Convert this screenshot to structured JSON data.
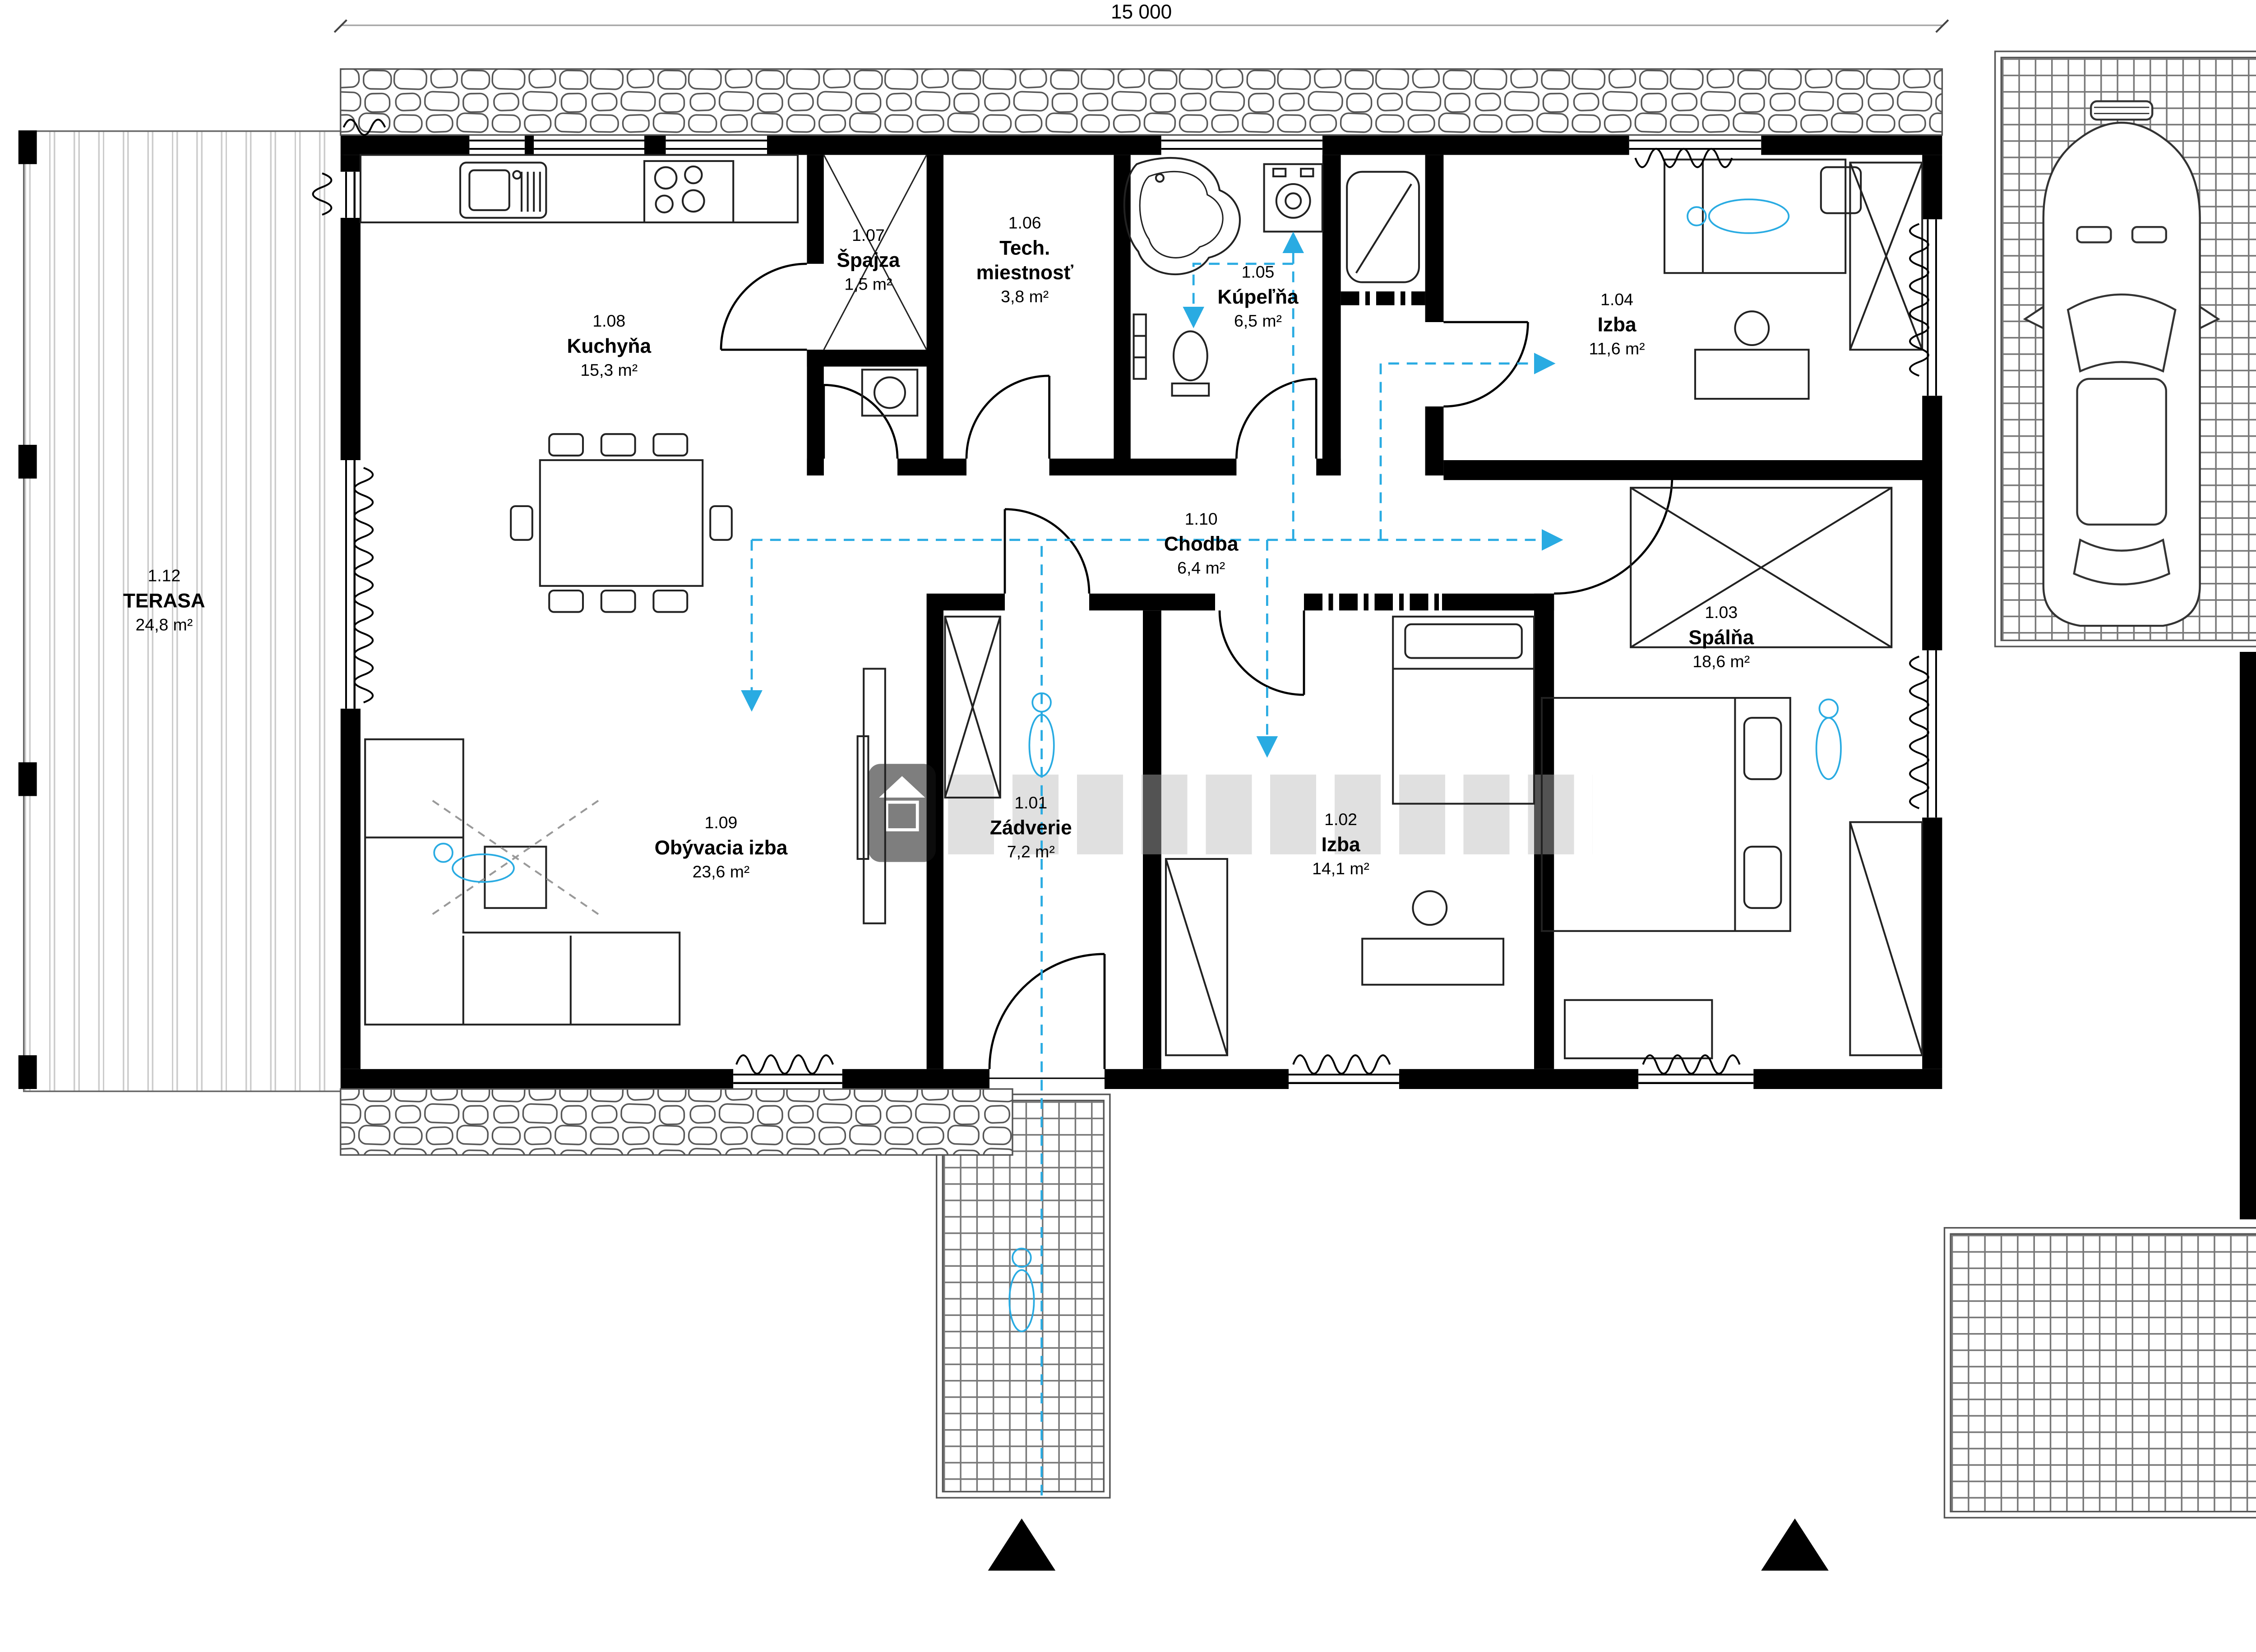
{
  "dimensions": {
    "width": "15 000",
    "height": "9 000",
    "window_detail": "420"
  },
  "rooms": [
    {
      "number": "1.01",
      "name": "Zádverie",
      "area": "7,2 m²"
    },
    {
      "number": "1.02",
      "name": "Izba",
      "area": "14,1 m²"
    },
    {
      "number": "1.03",
      "name": "Spálňa",
      "area": "18,6 m²"
    },
    {
      "number": "1.04",
      "name": "Izba",
      "area": "11,6 m²"
    },
    {
      "number": "1.05",
      "name": "Kúpeľňa",
      "area": "6,5 m²"
    },
    {
      "number": "1.06",
      "name": "Tech. miestnosť",
      "area": "3,8 m²"
    },
    {
      "number": "1.07",
      "name": "Špajza",
      "area": "1,5 m²"
    },
    {
      "number": "1.08",
      "name": "Kuchyňa",
      "area": "15,3 m²"
    },
    {
      "number": "1.09",
      "name": "Obývacia izba",
      "area": "23,6 m²"
    },
    {
      "number": "1.10",
      "name": "Chodba",
      "area": "6,4 m²"
    },
    {
      "number": "1.12",
      "name": "TERASA",
      "area": "24,8 m²"
    }
  ],
  "colors": {
    "wall": "#000000",
    "flow_arrow": "#29abe2",
    "dimension_line": "#a6a6a6",
    "paving_grid": "#787878",
    "watermark": "#b9b9b9"
  }
}
